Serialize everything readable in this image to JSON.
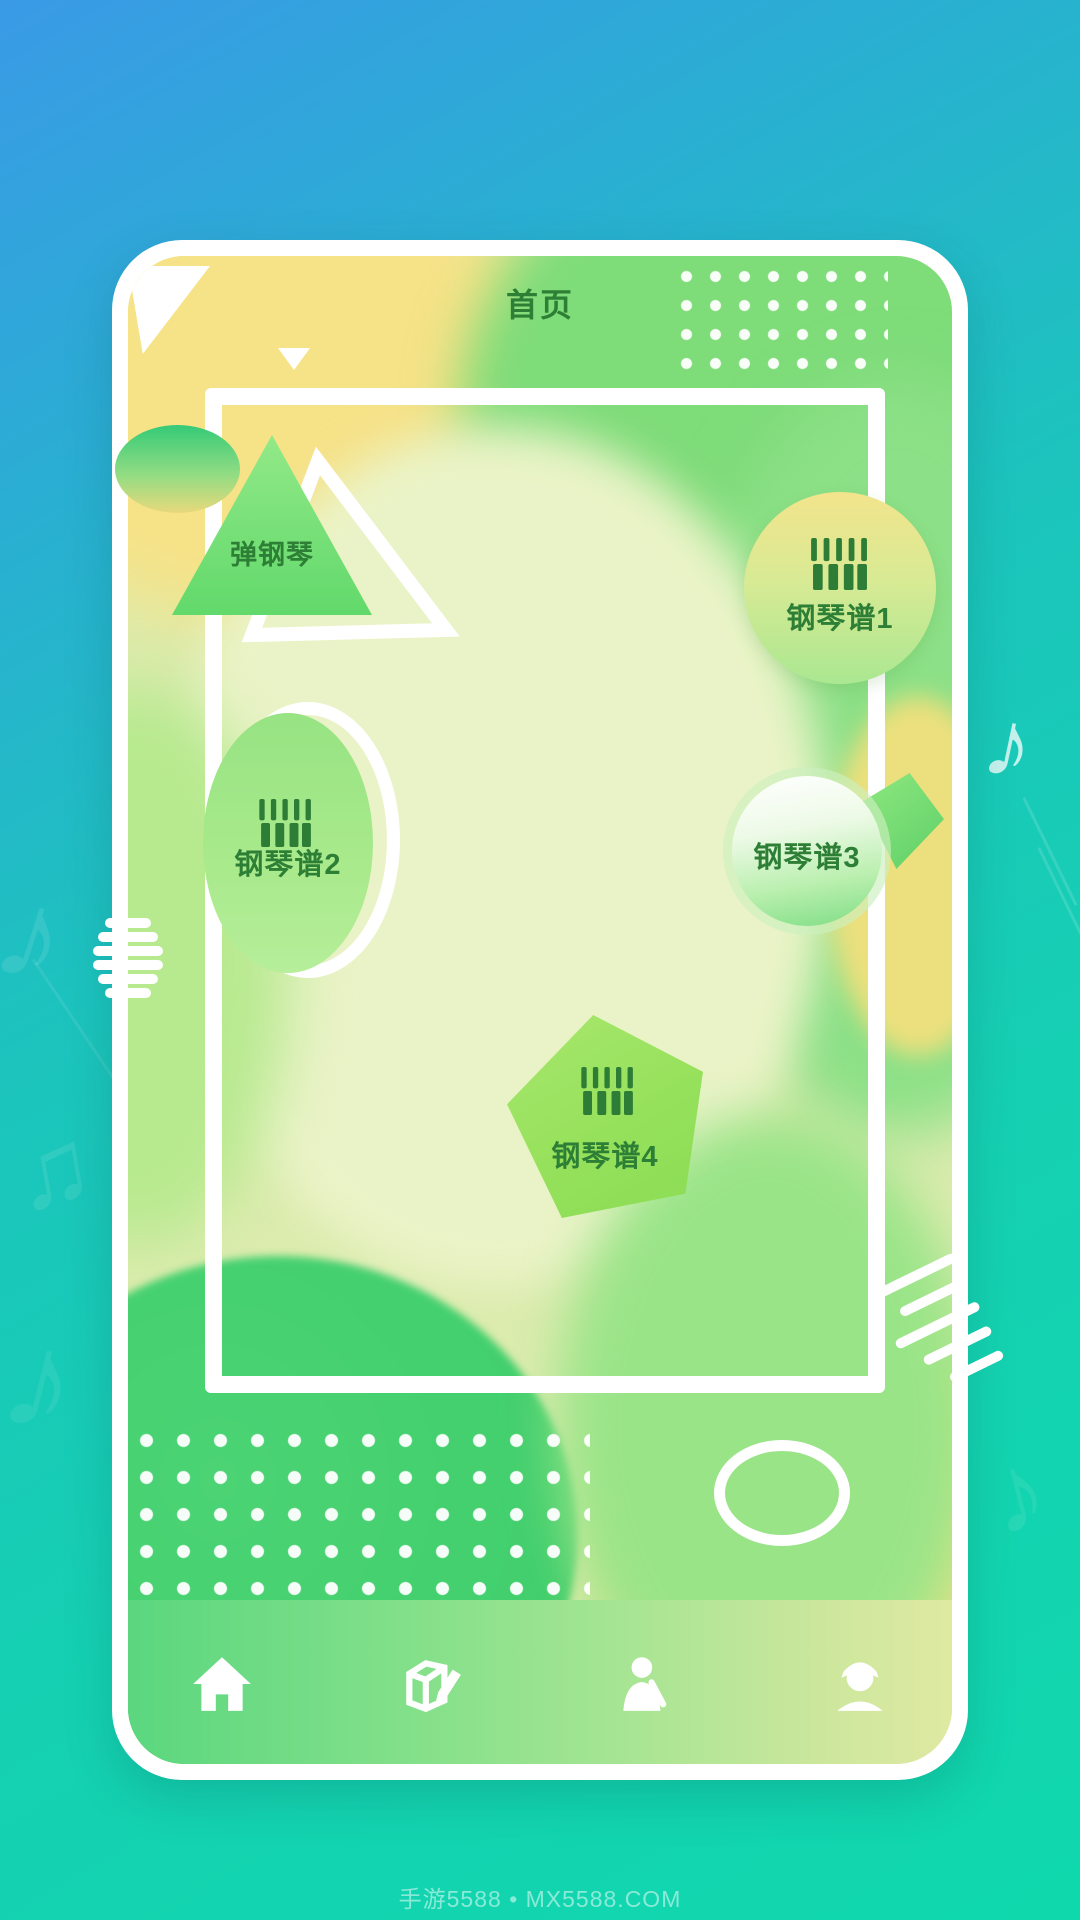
{
  "app": {
    "title": "首页",
    "watermark": "手游5588 • MX5588.COM"
  },
  "menu": {
    "play": {
      "label": "弹钢琴"
    },
    "score1": {
      "label": "钢琴谱1",
      "icon": "piano-keys-icon"
    },
    "score2": {
      "label": "钢琴谱2",
      "icon": "piano-keys-icon"
    },
    "score3": {
      "label": "钢琴谱3"
    },
    "score4": {
      "label": "钢琴谱4",
      "icon": "piano-keys-icon"
    }
  },
  "nav": {
    "items": [
      {
        "name": "home",
        "icon": "home-icon"
      },
      {
        "name": "edit",
        "icon": "edit-box-icon"
      },
      {
        "name": "compose",
        "icon": "person-pencil-icon"
      },
      {
        "name": "profile",
        "icon": "person-cap-icon"
      }
    ]
  },
  "colors": {
    "background_blue": "#3A9AE6",
    "background_teal": "#12D6AF",
    "card_text_green": "#2E7F36",
    "icon_green": "#2E7D36",
    "accent_white": "#FFFFFF"
  }
}
